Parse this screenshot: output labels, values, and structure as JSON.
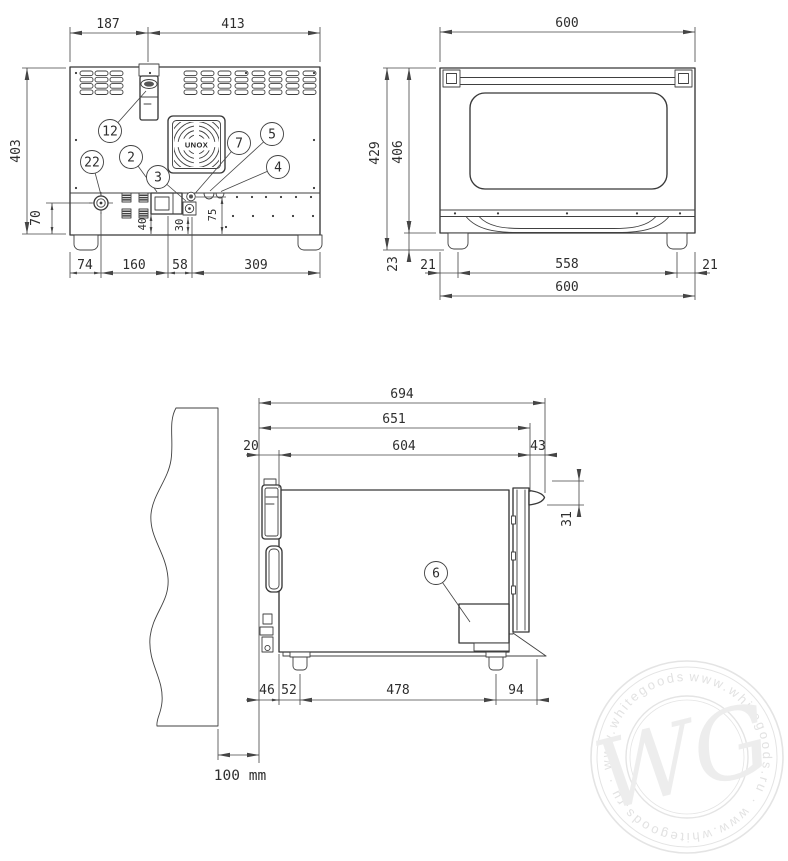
{
  "rear_view": {
    "dims": {
      "w_left": "187",
      "w_right": "413",
      "height": "403",
      "h_gland": "70",
      "b1": "74",
      "b2": "160",
      "b3": "58",
      "b4": "309",
      "s40": "40",
      "s30": "30",
      "s75": "75"
    },
    "callouts": {
      "c12": "12",
      "c22": "22",
      "c2": "2",
      "c3": "3",
      "c7": "7",
      "c5": "5",
      "c4": "4"
    },
    "fan_label": "UNOX"
  },
  "front_view": {
    "dims": {
      "w_top": "600",
      "h_total": "429",
      "h_body": "406",
      "h_foot": "23",
      "inset_l": "21",
      "feet_span": "558",
      "inset_r": "21",
      "w_bottom": "600"
    }
  },
  "side_view": {
    "dims": {
      "d_total": "694",
      "d_651": "651",
      "d_20": "20",
      "d_604": "604",
      "d_43": "43",
      "d_31": "31",
      "d_46": "46",
      "d_52": "52",
      "d_478": "478",
      "d_94": "94",
      "wall_clearance": "100 mm"
    },
    "callouts": {
      "c6": "6"
    }
  },
  "watermark": {
    "monogram": "WG",
    "ring_text": "www.whitegoods.ru · www.whitegoods.ru · www.whitegoods.ru ·"
  }
}
